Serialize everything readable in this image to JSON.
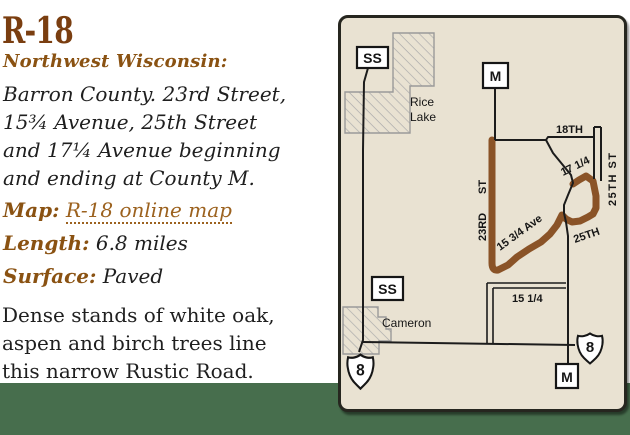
{
  "article": {
    "title": "R-18",
    "region_label": "Northwest Wisconsin:",
    "description_lines": [
      "Barron County. 23rd Street,",
      "15¾ Avenue, 25th Street",
      "and 17¼ Avenue beginning",
      "and ending at County M."
    ],
    "map_label": "Map:",
    "map_link_text": "R-18 online map",
    "length_label": "Length:",
    "length_value": "6.8 miles",
    "surface_label": "Surface:",
    "surface_value": "Paved",
    "notes_lines": [
      "Dense stands of white oak,",
      "aspen and birch trees line",
      "this narrow Rustic Road."
    ],
    "colors": {
      "title": "#7a3e10",
      "label": "#8a5212",
      "link": "#9c621f",
      "body": "#1f1f1f"
    }
  },
  "page": {
    "background": "#ffffff",
    "footer_band_color": "#476e4d"
  },
  "map": {
    "background": "#e9e2d2",
    "border_color": "#26261f",
    "route_color": "#8a5327",
    "road_color": "#1c1c1c",
    "hatch_color": "#ababab",
    "places": {
      "rice_lake_line1": "Rice",
      "rice_lake_line2": "Lake",
      "cameron": "Cameron"
    },
    "road_labels": {
      "eighteenth": "18TH",
      "twentyfifth_st": "25TH ST",
      "twentythird_num": "23RD",
      "twentythird_st": "ST",
      "fifteen_three_quarter_ave": "15 3/4 Ave",
      "twentyfifth": "25TH",
      "seventeen_one_quarter": "17 1/4",
      "fifteen_one_quarter": "15 1/4"
    },
    "markers": {
      "ss_top": "SS",
      "m_top": "M",
      "ss_bottom": "SS",
      "m_bottom": "M"
    },
    "shields": {
      "us8_left": "8",
      "us8_right": "8"
    }
  }
}
